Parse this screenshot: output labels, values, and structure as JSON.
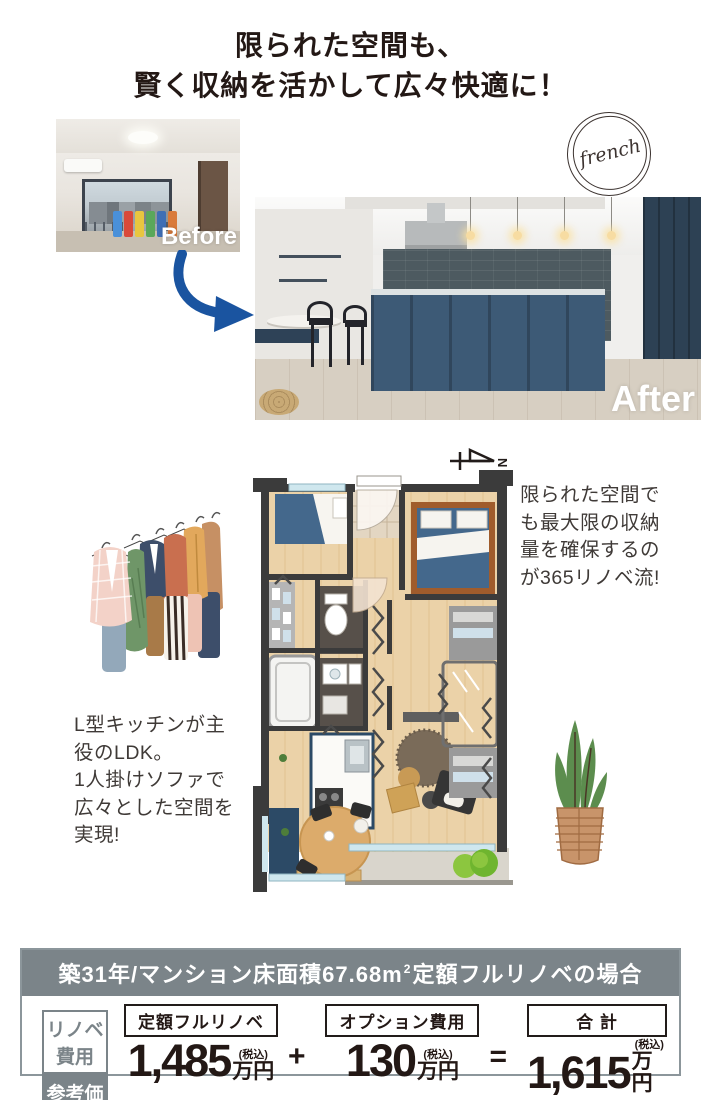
{
  "title": {
    "line1": "限られた空間も、",
    "line2": "賢く収納を活かして広々快適に！"
  },
  "photos": {
    "before_label": "Before",
    "after_label": "After"
  },
  "stamp": {
    "text": "french"
  },
  "compass": {
    "label": "N"
  },
  "notes": {
    "right": {
      "l1": "限られた空間で",
      "l2": "も最大限の収納",
      "l3": "量を確保するの",
      "l4": "が365リノベ流!"
    },
    "left": {
      "l1": "L型キッチンが主",
      "l2": "役のLDK。",
      "l3": "1人掛けソファで",
      "l4": "広々とした空間を",
      "l5": "実現!"
    }
  },
  "pricing": {
    "header_main": "築31年/マンション床面積67.68m",
    "header_sup": "2",
    "header_tail": "定額フルリノベの場合",
    "label_top": "リノベ費用",
    "label_bottom": "参考価格",
    "col1_label": "定額フルリノベ",
    "col1_amount": "1,485",
    "col2_label": "オプション費用",
    "col2_amount": "130",
    "col3_label": "合 計",
    "col3_amount": "1,615",
    "tax_note": "(税込)",
    "unit": "万円",
    "plus": "+",
    "equals": "="
  },
  "colors": {
    "arrow_blue": "#1a54a0",
    "header_gray": "#7b8489",
    "ink": "#231815",
    "island_blue": "#3d5a76"
  }
}
